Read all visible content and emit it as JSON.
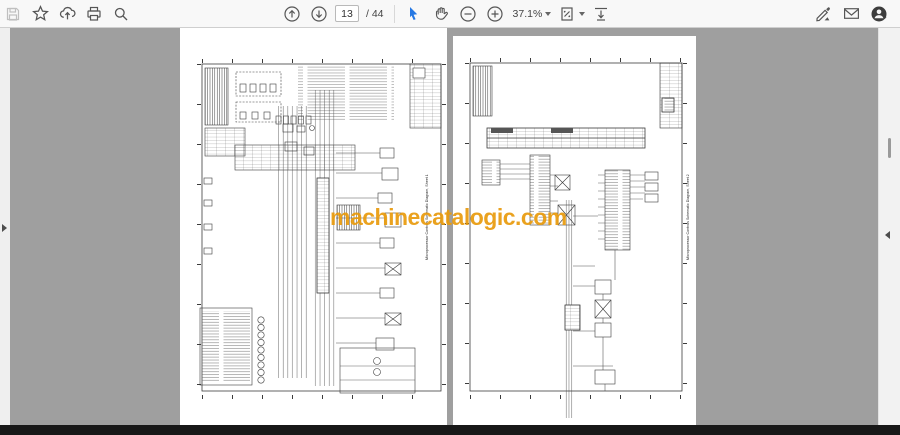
{
  "toolbar": {
    "page_number": "13",
    "page_total": "/ 44",
    "zoom_level": "37.1%",
    "icons": [
      "save",
      "bookmark-star",
      "share-upload",
      "print",
      "search",
      "page-up",
      "page-down",
      "select-tool",
      "hand-tool",
      "zoom-out",
      "zoom-in",
      "zoom-level-dropdown",
      "fit-page-dropdown",
      "scroll-mode",
      "fill-sign",
      "email",
      "account"
    ]
  },
  "watermark": {
    "text": "machinecatalogic.com",
    "color": "#E89A0C"
  },
  "viewer": {
    "left_page": {
      "vertical_title": "Microprocessor Controls Schematic Diagram, Sheet 1"
    },
    "right_page": {
      "vertical_title": "Microprocessor Controls Schematic Diagram, Sheet 2"
    }
  },
  "colors": {
    "toolbar_background": "#f8f8f8",
    "viewer_background": "#9f9f9f",
    "bottom_bar": "#181818",
    "select_tool_blue": "#2678e3",
    "watermark_orange": "#E89A0C"
  }
}
